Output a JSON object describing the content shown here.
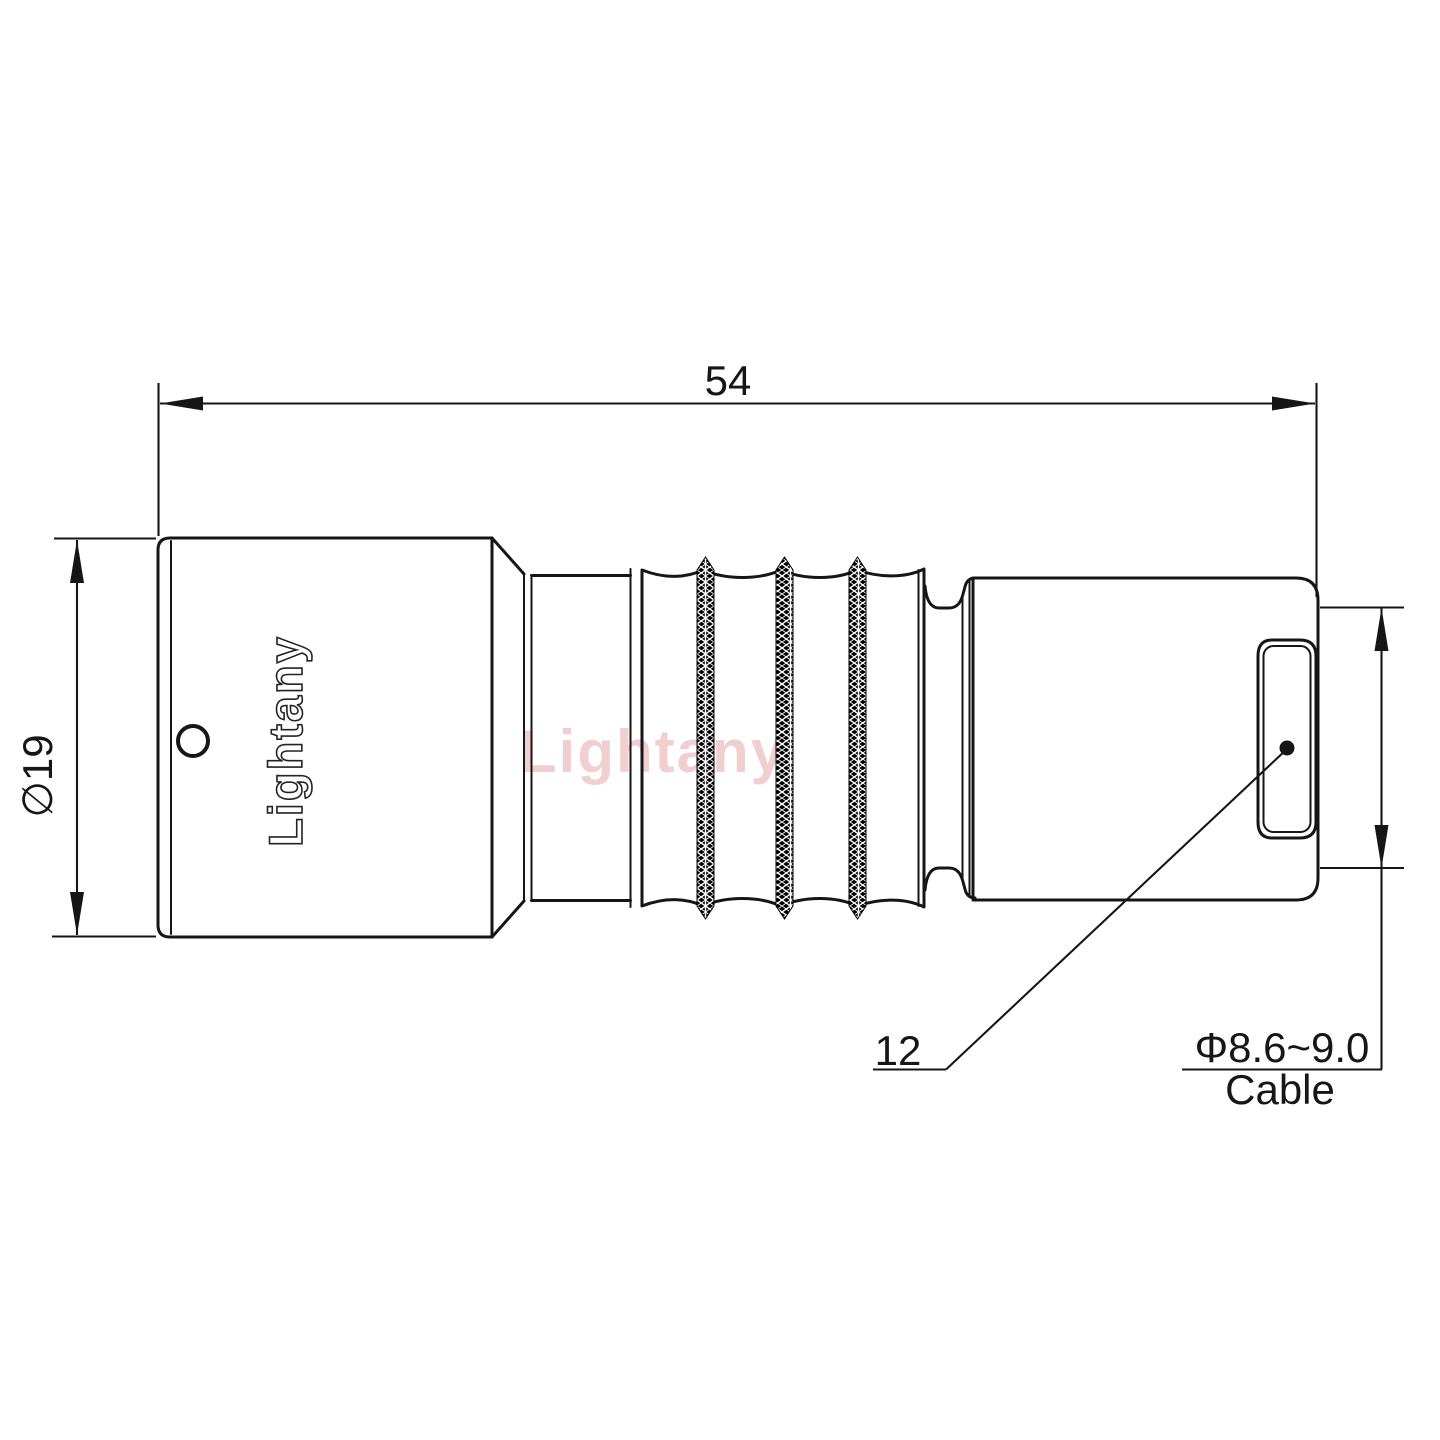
{
  "drawing": {
    "type": "technical-drawing",
    "part": "push-pull circular connector plug, side view",
    "watermark": {
      "text": "Lightany",
      "color": "#e9a9a9"
    },
    "connector": {
      "engraving": "Lightany"
    },
    "dimensions": {
      "overall_length": {
        "value": "54"
      },
      "body_diameter": {
        "value": "∅19"
      },
      "boot_size": {
        "value": "12"
      },
      "cable": {
        "value": "Φ8.6~9.0",
        "label": "Cable"
      }
    },
    "colors": {
      "line": "#161616",
      "background": "#ffffff",
      "knurl_fill": "#000000"
    }
  }
}
